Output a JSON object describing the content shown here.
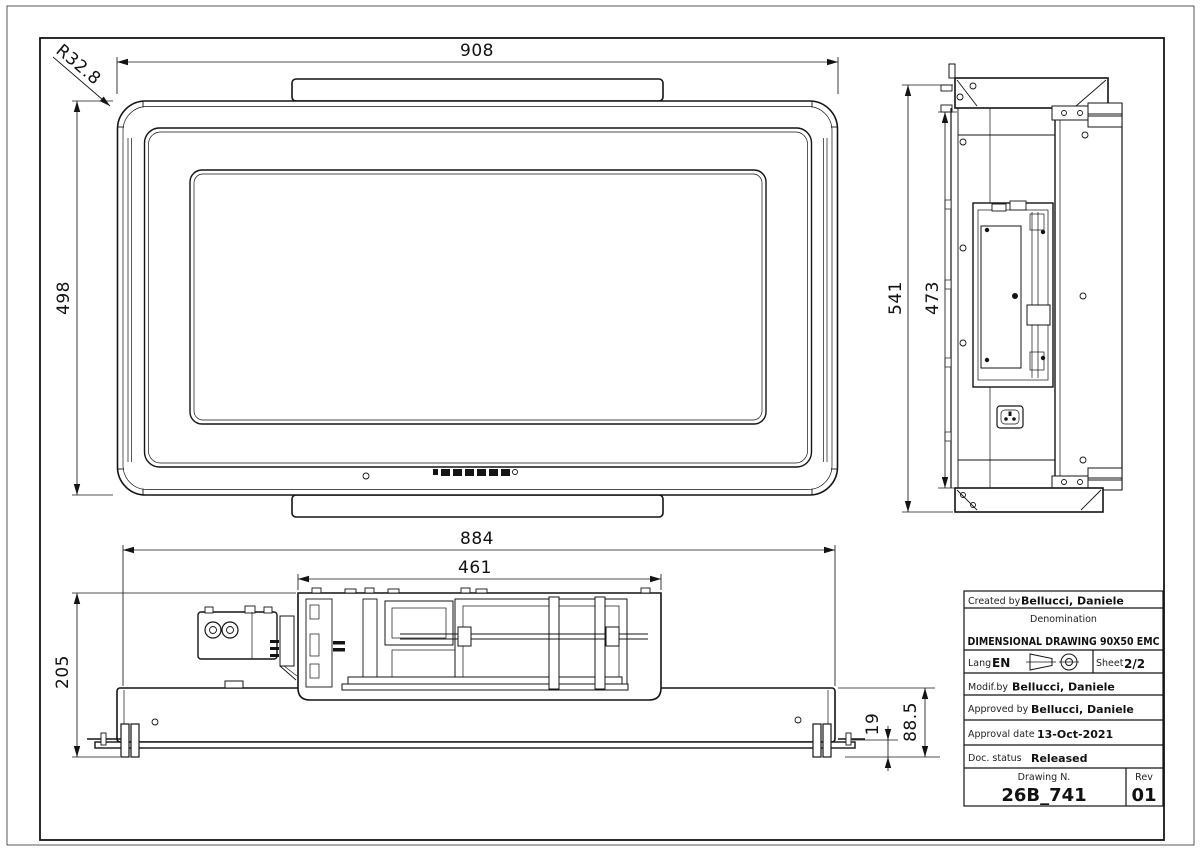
{
  "sheet": {
    "background": "#ffffff",
    "line_color": "#141414"
  },
  "dimensions": {
    "top_view": {
      "width": "908",
      "height": "498",
      "corner_radius": "R32.8"
    },
    "side_view": {
      "total_height": "541",
      "inner_height": "473"
    },
    "front_view": {
      "body_width": "884",
      "fan_unit_width": "461",
      "total_height": "205",
      "foot_offset": "19",
      "lower_height": "88.5"
    }
  },
  "icons": {
    "projection": "first-angle-projection-symbol",
    "socket": "iec-power-socket"
  },
  "title_block": {
    "created_by_label": "Created by",
    "created_by": "Bellucci, Daniele",
    "denomination_label": "Denomination",
    "denomination": "DIMENSIONAL DRAWING 90X50 EMC",
    "lang_label": "Lang",
    "lang": "EN",
    "sheet_label": "Sheet",
    "sheet": "2/2",
    "modified_by_label": "Modif.by",
    "modified_by": "Bellucci, Daniele",
    "approved_by_label": "Approved by",
    "approved_by": "Bellucci, Daniele",
    "approval_date_label": "Approval date",
    "approval_date": "13-Oct-2021",
    "doc_status_label": "Doc. status",
    "doc_status": "Released",
    "drawing_number_label": "Drawing N.",
    "drawing_number": "26B_741",
    "rev_label": "Rev",
    "rev": "01"
  }
}
